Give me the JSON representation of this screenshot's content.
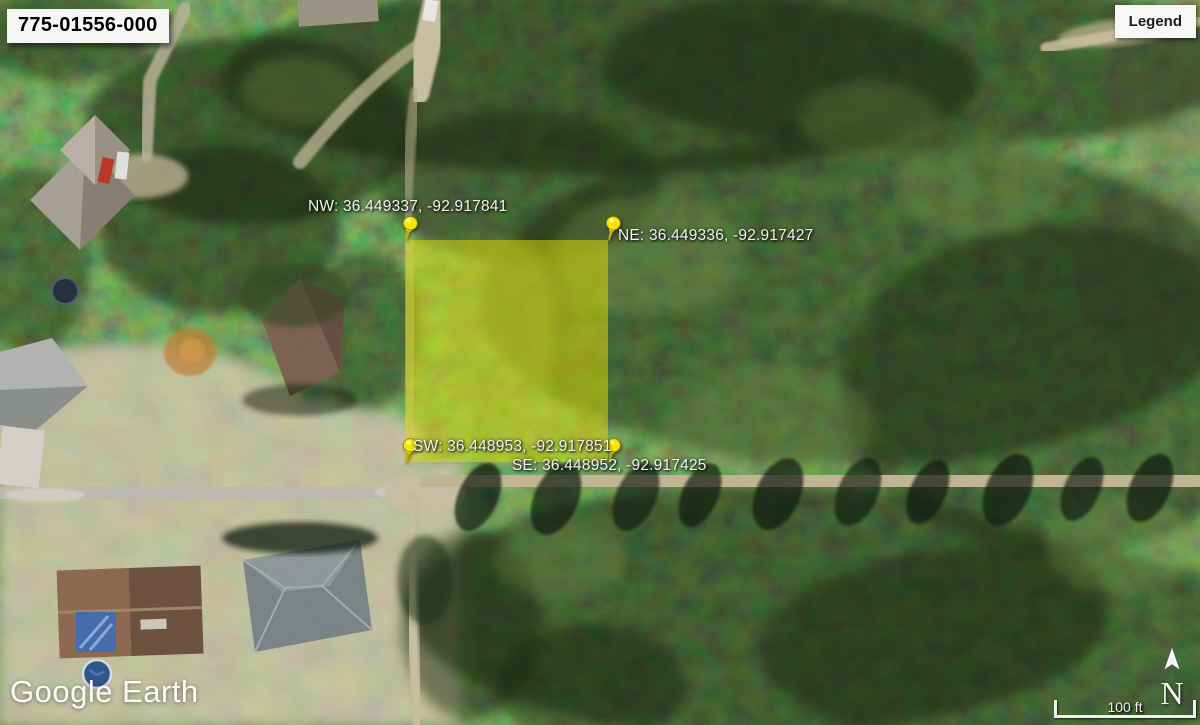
{
  "app": {
    "name": "Google Earth"
  },
  "parcel": {
    "id": "775-01556-000",
    "highlight_color": "#e3e300",
    "corners": [
      {
        "id": "NW",
        "label": "NW: 36.449337, -92.917841",
        "lat": "36.449337",
        "lon": "-92.917841"
      },
      {
        "id": "NE",
        "label": "NE: 36.449336, -92.917427",
        "lat": "36.449336",
        "lon": "-92.917427"
      },
      {
        "id": "SW",
        "label": "SW: 36.448953, -92.917851",
        "lat": "36.448953",
        "lon": "-92.917851"
      },
      {
        "id": "SE",
        "label": "SE: 36.448952, -92.917425",
        "lat": "36.448952",
        "lon": "-92.917425"
      }
    ]
  },
  "legend_button": {
    "label": "Legend"
  },
  "watermark": {
    "text": "Google Earth"
  },
  "compass": {
    "label": "N"
  },
  "scale_bar": {
    "label": "100 ft"
  },
  "colors": {
    "pin": "#f6e60c",
    "label_text": "#f2f2f2",
    "panel_bg": "#f5f5f3",
    "panel_text": "#111111"
  }
}
